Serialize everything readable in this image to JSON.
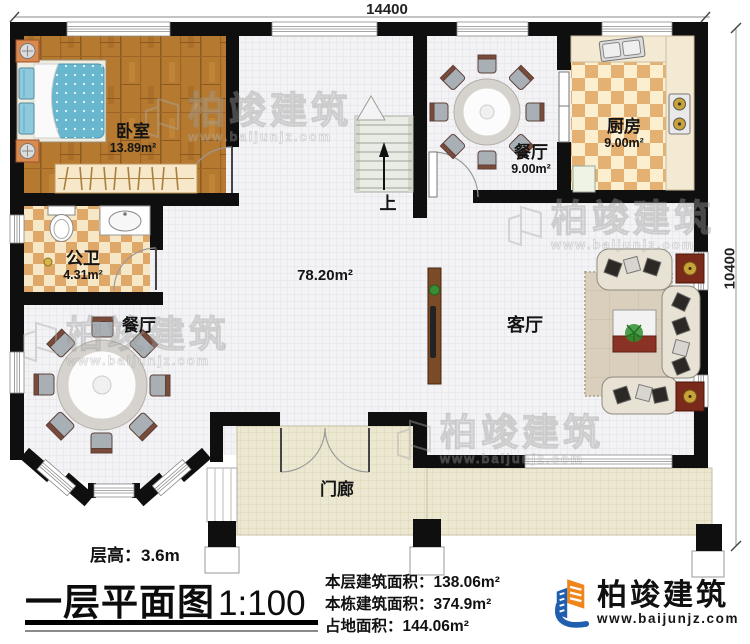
{
  "dimensions": {
    "width_label": "14400",
    "height_label": "10400"
  },
  "rooms": {
    "bedroom": {
      "name": "卧室",
      "area": "13.89m²"
    },
    "bathroom": {
      "name": "公卫",
      "area": "4.31m²"
    },
    "dining_top": {
      "name": "餐厅",
      "area": "9.00m²"
    },
    "kitchen": {
      "name": "厨房",
      "area": "9.00m²"
    },
    "dining_bottom": {
      "name": "餐厅"
    },
    "living": {
      "name": "客厅",
      "area": "78.20m²"
    },
    "porch": {
      "name": "门廊"
    },
    "stairs": {
      "direction": "上"
    }
  },
  "annotations": {
    "floor_height": "层高：3.6m",
    "title": "一层平面图",
    "scale": "1:100",
    "stats": [
      "本层建筑面积：138.06m²",
      "本栋建筑面积：374.9m²",
      "占地面积：144.06m²"
    ]
  },
  "branding": {
    "company": "柏竣建筑",
    "website": "www.baijunjz.com"
  },
  "colors": {
    "wall": "#0f0f0f",
    "wood_floor": "#b5792f",
    "tile_checker": "#e2a968",
    "porch_floor": "#ece7d0",
    "logo_blue": "#1f5fae",
    "logo_orange": "#f08519",
    "accent_red": "#7a2a1a"
  }
}
